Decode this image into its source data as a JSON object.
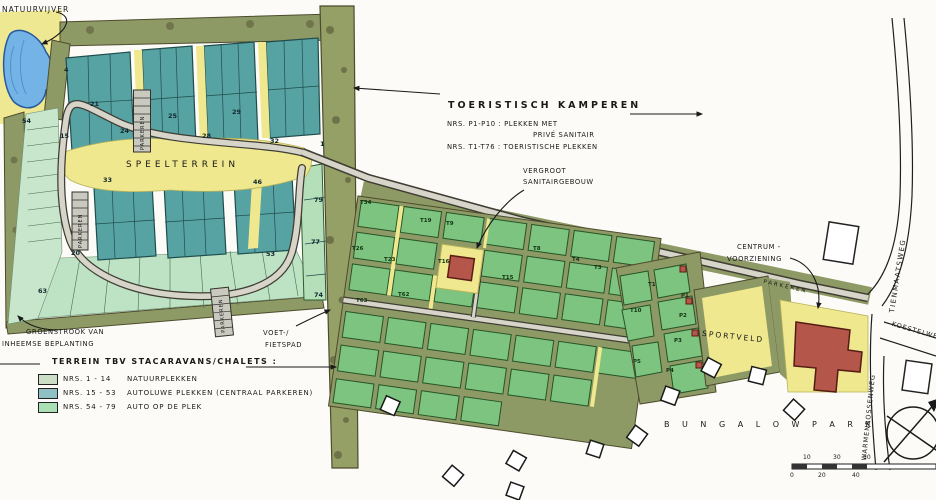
{
  "annotations": {
    "natuurvijver": "NATUURVIJVER",
    "toeristisch_title": "TOERISTISCH KAMPEREN",
    "toeristisch_note1": "NRS. P1-P10 :  PLEKKEN MET",
    "toeristisch_note2": "PRIVÉ SANITAIR",
    "toeristisch_note3": "NRS. T1-T76 :  TOERISTISCHE PLEKKEN",
    "vergroot_line1": "VERGROOT",
    "vergroot_line2": "SANITAIRGEBOUW",
    "centrum_line1": "CENTRUM -",
    "centrum_line2": "VOORZIENING",
    "groenstrook_line1": "GROENSTROOK VAN",
    "groenstrook_line2": "INHEEMSE BEPLANTING",
    "voetpad_line1": "VOET-/",
    "voetpad_line2": "FIETSPAD",
    "speelterrein": "SPEELTERREIN",
    "sportveld": "SPORTVELD",
    "bungalowpark": "B U N G A L O W P A R K",
    "parkeren": "PARKEREN"
  },
  "legend": {
    "title": "TERREIN TBV STACARAVANS/CHALETS :",
    "items": [
      {
        "range": "NRS. 1 - 14",
        "label": "NATUURPLEKKEN",
        "color": "#ccdec6"
      },
      {
        "range": "NRS. 15 - 53",
        "label": "AUTOLUWE PLEKKEN (CENTRAAL PARKEREN)",
        "color": "#8fc0c6"
      },
      {
        "range": "NRS. 54 - 79",
        "label": "AUTO OP DE PLEK",
        "color": "#abe0b4"
      }
    ]
  },
  "roads": {
    "tienmaatsweg": "TIENMAATSWEG",
    "koestelweg": "KOESTELWEG",
    "warmenbossenweg": "WARMENBOSSENWEG"
  },
  "colors": {
    "pond_blue": "#74b3e6",
    "teal_plots": "#57a2a2",
    "green_plots": "#7cc47f",
    "mint_plots": "#c8e6cc",
    "hedge_olive": "#8d9a65",
    "path_yellow": "#efe88e",
    "building_red": "#b4564a"
  },
  "plot_numbers": [
    {
      "t": "4",
      "x": 64,
      "y": 66
    },
    {
      "t": "21",
      "x": 90,
      "y": 100
    },
    {
      "t": "25",
      "x": 168,
      "y": 112
    },
    {
      "t": "29",
      "x": 232,
      "y": 108
    },
    {
      "t": "24",
      "x": 120,
      "y": 127
    },
    {
      "t": "28",
      "x": 202,
      "y": 132
    },
    {
      "t": "32",
      "x": 270,
      "y": 137
    },
    {
      "t": "15",
      "x": 60,
      "y": 132
    },
    {
      "t": "33",
      "x": 103,
      "y": 176
    },
    {
      "t": "46",
      "x": 253,
      "y": 178
    },
    {
      "t": "20",
      "x": 71,
      "y": 249
    },
    {
      "t": "54",
      "x": 22,
      "y": 117
    },
    {
      "t": "63",
      "x": 38,
      "y": 287
    },
    {
      "t": "53",
      "x": 266,
      "y": 250
    },
    {
      "t": "79",
      "x": 314,
      "y": 196
    },
    {
      "t": "77",
      "x": 311,
      "y": 238
    },
    {
      "t": "74",
      "x": 314,
      "y": 291
    },
    {
      "t": "1",
      "x": 320,
      "y": 140
    }
  ],
  "t_plots": [
    {
      "t": "T34",
      "x": 360,
      "y": 200
    },
    {
      "t": "T19",
      "x": 420,
      "y": 218
    },
    {
      "t": "T9",
      "x": 446,
      "y": 221
    },
    {
      "t": "T26",
      "x": 352,
      "y": 246
    },
    {
      "t": "T23",
      "x": 384,
      "y": 257
    },
    {
      "t": "T16",
      "x": 438,
      "y": 259
    },
    {
      "t": "T15",
      "x": 502,
      "y": 275
    },
    {
      "t": "T8",
      "x": 533,
      "y": 246
    },
    {
      "t": "T4",
      "x": 572,
      "y": 257
    },
    {
      "t": "T3",
      "x": 594,
      "y": 265
    },
    {
      "t": "T63",
      "x": 356,
      "y": 298
    },
    {
      "t": "T62",
      "x": 398,
      "y": 292
    },
    {
      "t": "T1",
      "x": 648,
      "y": 282
    },
    {
      "t": "T10",
      "x": 630,
      "y": 308
    }
  ],
  "p_plots": [
    {
      "t": "P1",
      "x": 681,
      "y": 293
    },
    {
      "t": "P2",
      "x": 679,
      "y": 313
    },
    {
      "t": "P3",
      "x": 674,
      "y": 338
    },
    {
      "t": "P4",
      "x": 666,
      "y": 368
    },
    {
      "t": "P5",
      "x": 633,
      "y": 359
    }
  ],
  "scale_labels": [
    {
      "t": "10",
      "x": 803,
      "y": 454
    },
    {
      "t": "30",
      "x": 833,
      "y": 454
    },
    {
      "t": "50",
      "x": 863,
      "y": 454
    },
    {
      "t": "0",
      "x": 790,
      "y": 472
    },
    {
      "t": "20",
      "x": 818,
      "y": 472
    },
    {
      "t": "40",
      "x": 852,
      "y": 472
    }
  ]
}
